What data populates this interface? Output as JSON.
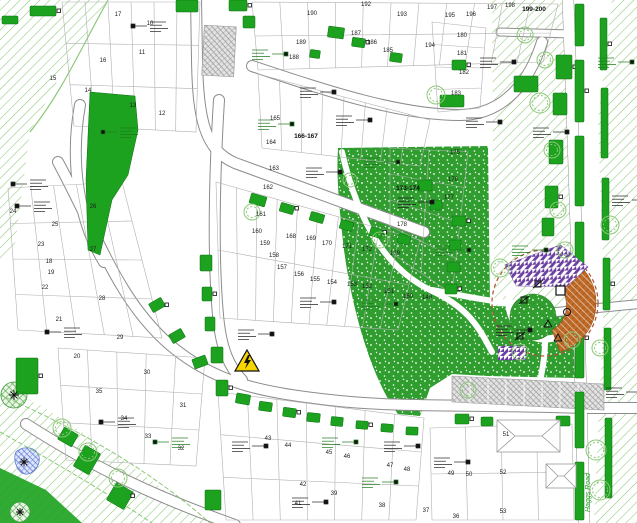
{
  "drawing": {
    "type_label": "residential landscape planting plan",
    "road_name": "Haggs Road"
  },
  "plots": [
    {
      "n": "10",
      "x": 150,
      "y": 25
    },
    {
      "n": "11",
      "x": 142,
      "y": 54
    },
    {
      "n": "12",
      "x": 162,
      "y": 115
    },
    {
      "n": "13",
      "x": 133,
      "y": 107
    },
    {
      "n": "14",
      "x": 88,
      "y": 92
    },
    {
      "n": "15",
      "x": 53,
      "y": 80
    },
    {
      "n": "16",
      "x": 103,
      "y": 62
    },
    {
      "n": "17",
      "x": 118,
      "y": 16
    },
    {
      "n": "18",
      "x": 49,
      "y": 263
    },
    {
      "n": "19",
      "x": 51,
      "y": 274
    },
    {
      "n": "20",
      "x": 77,
      "y": 358
    },
    {
      "n": "21",
      "x": 59,
      "y": 321
    },
    {
      "n": "22",
      "x": 45,
      "y": 289
    },
    {
      "n": "23",
      "x": 41,
      "y": 246
    },
    {
      "n": "24",
      "x": 13,
      "y": 213
    },
    {
      "n": "25",
      "x": 55,
      "y": 226
    },
    {
      "n": "26",
      "x": 93,
      "y": 208
    },
    {
      "n": "27",
      "x": 93,
      "y": 251
    },
    {
      "n": "28",
      "x": 102,
      "y": 300
    },
    {
      "n": "29",
      "x": 120,
      "y": 339
    },
    {
      "n": "30",
      "x": 147,
      "y": 374
    },
    {
      "n": "31",
      "x": 183,
      "y": 407
    },
    {
      "n": "32",
      "x": 181,
      "y": 450
    },
    {
      "n": "33",
      "x": 148,
      "y": 438
    },
    {
      "n": "34",
      "x": 124,
      "y": 420
    },
    {
      "n": "35",
      "x": 99,
      "y": 393
    },
    {
      "n": "36",
      "x": 456,
      "y": 518
    },
    {
      "n": "37",
      "x": 426,
      "y": 512
    },
    {
      "n": "38",
      "x": 382,
      "y": 507
    },
    {
      "n": "39",
      "x": 334,
      "y": 495
    },
    {
      "n": "41",
      "x": 298,
      "y": 505
    },
    {
      "n": "42",
      "x": 303,
      "y": 486
    },
    {
      "n": "43",
      "x": 268,
      "y": 440
    },
    {
      "n": "44",
      "x": 288,
      "y": 447
    },
    {
      "n": "45",
      "x": 329,
      "y": 454
    },
    {
      "n": "46",
      "x": 347,
      "y": 458
    },
    {
      "n": "47",
      "x": 390,
      "y": 467
    },
    {
      "n": "48",
      "x": 407,
      "y": 471
    },
    {
      "n": "49",
      "x": 451,
      "y": 475
    },
    {
      "n": "50",
      "x": 469,
      "y": 476
    },
    {
      "n": "51",
      "x": 506,
      "y": 436
    },
    {
      "n": "52",
      "x": 503,
      "y": 474
    },
    {
      "n": "53",
      "x": 503,
      "y": 513
    },
    {
      "n": "149",
      "x": 427,
      "y": 299
    },
    {
      "n": "150",
      "x": 408,
      "y": 298
    },
    {
      "n": "151",
      "x": 389,
      "y": 293
    },
    {
      "n": "152",
      "x": 367,
      "y": 288
    },
    {
      "n": "153",
      "x": 352,
      "y": 286
    },
    {
      "n": "154",
      "x": 332,
      "y": 284
    },
    {
      "n": "155",
      "x": 315,
      "y": 281
    },
    {
      "n": "156",
      "x": 299,
      "y": 276
    },
    {
      "n": "157",
      "x": 282,
      "y": 269
    },
    {
      "n": "158",
      "x": 274,
      "y": 257
    },
    {
      "n": "159",
      "x": 265,
      "y": 245
    },
    {
      "n": "160",
      "x": 257,
      "y": 233
    },
    {
      "n": "161",
      "x": 261,
      "y": 216
    },
    {
      "n": "162",
      "x": 268,
      "y": 189
    },
    {
      "n": "163",
      "x": 274,
      "y": 170
    },
    {
      "n": "164",
      "x": 271,
      "y": 144
    },
    {
      "n": "165",
      "x": 275,
      "y": 120
    },
    {
      "n": "168",
      "x": 291,
      "y": 238
    },
    {
      "n": "169",
      "x": 311,
      "y": 240
    },
    {
      "n": "170",
      "x": 327,
      "y": 245
    },
    {
      "n": "171",
      "x": 347,
      "y": 248
    },
    {
      "n": "172",
      "x": 367,
      "y": 251
    },
    {
      "n": "175",
      "x": 455,
      "y": 154
    },
    {
      "n": "176",
      "x": 453,
      "y": 181
    },
    {
      "n": "177",
      "x": 449,
      "y": 199
    },
    {
      "n": "178",
      "x": 402,
      "y": 226
    },
    {
      "n": "179",
      "x": 395,
      "y": 255
    },
    {
      "n": "180",
      "x": 462,
      "y": 37
    },
    {
      "n": "181",
      "x": 462,
      "y": 55
    },
    {
      "n": "182",
      "x": 464,
      "y": 74
    },
    {
      "n": "183",
      "x": 456,
      "y": 95
    },
    {
      "n": "185",
      "x": 388,
      "y": 52
    },
    {
      "n": "186",
      "x": 372,
      "y": 44
    },
    {
      "n": "187",
      "x": 356,
      "y": 35
    },
    {
      "n": "188",
      "x": 294,
      "y": 59
    },
    {
      "n": "189",
      "x": 301,
      "y": 44
    },
    {
      "n": "190",
      "x": 312,
      "y": 15
    },
    {
      "n": "192",
      "x": 366,
      "y": 6
    },
    {
      "n": "193",
      "x": 402,
      "y": 16
    },
    {
      "n": "194",
      "x": 430,
      "y": 47
    },
    {
      "n": "195",
      "x": 450,
      "y": 17
    },
    {
      "n": "196",
      "x": 471,
      "y": 16
    },
    {
      "n": "197",
      "x": 492,
      "y": 9
    },
    {
      "n": "198",
      "x": 510,
      "y": 7
    }
  ],
  "range_labels": [
    {
      "text": "166-167",
      "x": 306,
      "y": 138
    },
    {
      "text": "173-174",
      "x": 408,
      "y": 190
    },
    {
      "text": "199-200",
      "x": 534,
      "y": 11
    }
  ],
  "road_name": "Haggs Road",
  "icons": {
    "warning": "electricity-warning-triangle",
    "warning_symbol": "lightning-bolt",
    "play_equipment": "play-equipment-glyphs",
    "existing_tree": "tree-burst"
  },
  "colors": {
    "bed_green": "#1ca21e",
    "grass_green": "#2f9e2f",
    "hatch_green": "#8cc878",
    "road_gray": "#8c8c8c",
    "parcel_gray": "#b0b0b0",
    "mulch_brown": "#c06a28",
    "safety_purple": "#6b3fa0",
    "pond_blue": "#5f79cc",
    "warning_yellow": "#f6d600",
    "play_edge_red": "#b05030"
  }
}
